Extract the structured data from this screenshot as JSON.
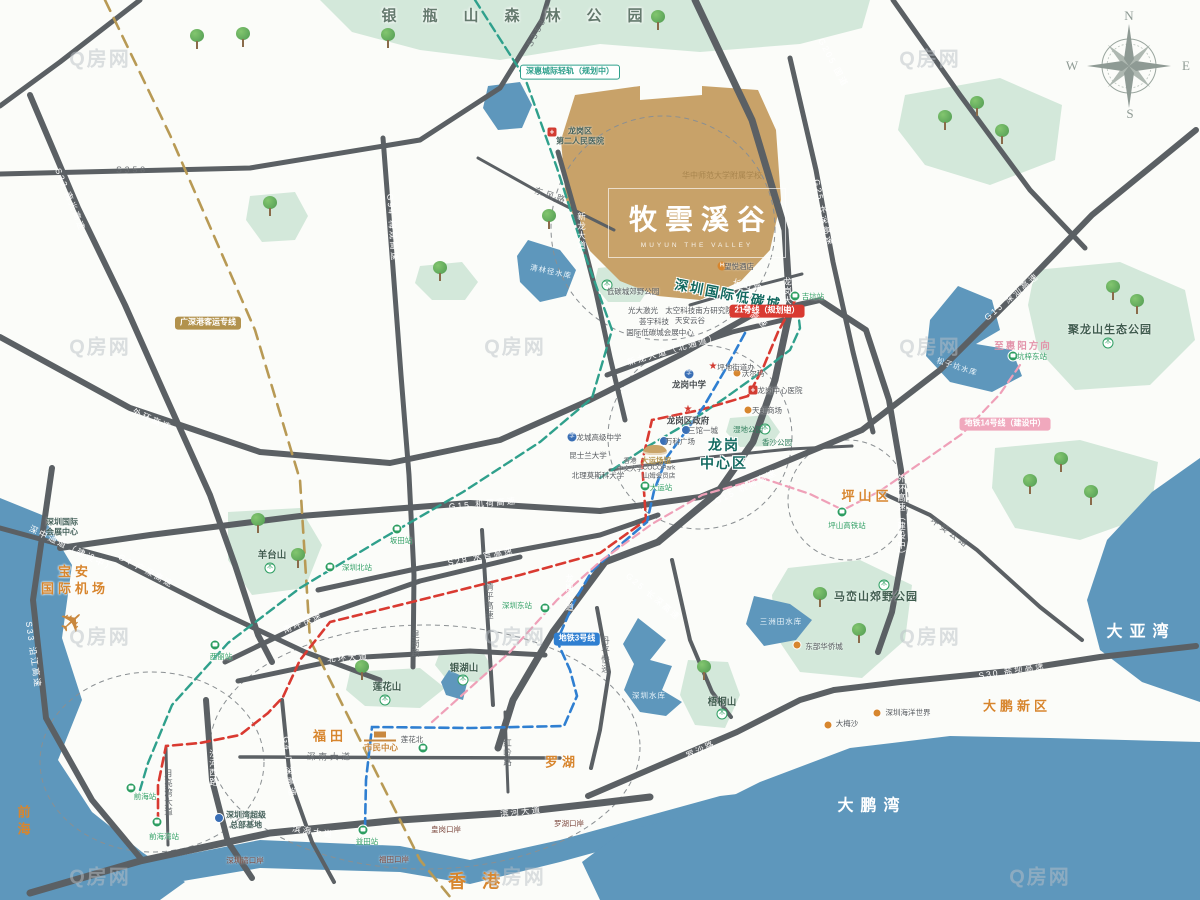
{
  "logo": {
    "title": "牧雲溪谷",
    "subtitle": "MUYUN THE VALLEY"
  },
  "compass": {
    "n": "N",
    "e": "E",
    "s": "S",
    "w": "W"
  },
  "watermark": {
    "text": "Q房网",
    "positions": [
      [
        100,
        57
      ],
      [
        515,
        345
      ],
      [
        930,
        57
      ],
      [
        100,
        345
      ],
      [
        100,
        635
      ],
      [
        515,
        635
      ],
      [
        930,
        345
      ],
      [
        930,
        635
      ],
      [
        100,
        875
      ],
      [
        515,
        875
      ],
      [
        1040,
        875
      ]
    ]
  },
  "map": {
    "labels": [
      {
        "t": "银瓶山森林公园",
        "x": 525,
        "y": 16,
        "c": "forest",
        "n": "label-yinpingshan-forest-park"
      },
      {
        "t": "深圳国际低碳城",
        "x": 728,
        "y": 295,
        "c": "lc",
        "r": 11,
        "n": "label-low-carbon-city"
      },
      {
        "t": "龙岗\n中心区",
        "x": 724,
        "y": 454,
        "c": "dt",
        "n": "label-longgang-center"
      },
      {
        "t": "坪山区",
        "x": 867,
        "y": 497,
        "c": "org",
        "n": "label-pingshan-district"
      },
      {
        "t": "大鹏新区",
        "x": 1017,
        "y": 707,
        "c": "org",
        "n": "label-dapeng-new-district"
      },
      {
        "t": "福田",
        "x": 330,
        "y": 737,
        "c": "org",
        "n": "label-futian"
      },
      {
        "t": "罗湖",
        "x": 562,
        "y": 763,
        "c": "org",
        "n": "label-luohu"
      },
      {
        "t": "香港",
        "x": 482,
        "y": 882,
        "c": "org-lg",
        "n": "label-hongkong"
      },
      {
        "t": "前海",
        "x": 22,
        "y": 822,
        "c": "org-v",
        "n": "label-qianhai"
      },
      {
        "t": "宝安\n国际机场",
        "x": 75,
        "y": 581,
        "c": "org",
        "n": "label-baoan-airport"
      },
      {
        "t": "大亚湾",
        "x": 1141,
        "y": 633,
        "c": "sea",
        "n": "label-daya-bay"
      },
      {
        "t": "大鹏湾",
        "x": 872,
        "y": 807,
        "c": "sea",
        "n": "label-dapeng-bay"
      },
      {
        "t": "聚龙山生态公园",
        "x": 1110,
        "y": 330,
        "c": "park"
      },
      {
        "t": "马峦山郊野公园",
        "x": 876,
        "y": 597,
        "c": "park"
      },
      {
        "t": "羊台山",
        "x": 272,
        "y": 556,
        "c": "park-s"
      },
      {
        "t": "莲花山",
        "x": 387,
        "y": 688,
        "c": "park-s"
      },
      {
        "t": "银湖山",
        "x": 464,
        "y": 669,
        "c": "park-s"
      },
      {
        "t": "梧桐山",
        "x": 722,
        "y": 703,
        "c": "park-s"
      },
      {
        "t": "松子坑水库",
        "x": 957,
        "y": 367,
        "c": "wat",
        "r": 18
      },
      {
        "t": "清林径水库",
        "x": 551,
        "y": 272,
        "c": "wat",
        "r": 12
      },
      {
        "t": "深圳水库",
        "x": 649,
        "y": 696,
        "c": "wat"
      },
      {
        "t": "三洲田水库",
        "x": 781,
        "y": 622,
        "c": "wat"
      },
      {
        "t": "深圳国际\n会展中心",
        "x": 62,
        "y": 528,
        "c": "poi2"
      },
      {
        "t": "深圳湾超级\n总部基地",
        "x": 246,
        "y": 821,
        "c": "poi2"
      },
      {
        "t": "市民中心",
        "x": 381,
        "y": 748,
        "c": "gold-s"
      },
      {
        "t": "莲花北",
        "x": 412,
        "y": 740,
        "c": "poi-t"
      },
      {
        "t": "福田口岸",
        "x": 394,
        "y": 860,
        "c": "port"
      },
      {
        "t": "皇岗口岸",
        "x": 446,
        "y": 830,
        "c": "port"
      },
      {
        "t": "罗湖口岸",
        "x": 569,
        "y": 824,
        "c": "port"
      },
      {
        "t": "深圳湾口岸",
        "x": 245,
        "y": 861,
        "c": "port"
      },
      {
        "t": "东部华侨城",
        "x": 824,
        "y": 647,
        "c": "poi-t"
      },
      {
        "t": "大梅沙",
        "x": 847,
        "y": 724,
        "c": "poi-t"
      },
      {
        "t": "深圳海洋世界",
        "x": 908,
        "y": 713,
        "c": "poi-t"
      },
      {
        "t": "坪山高铁站",
        "x": 847,
        "y": 526,
        "c": "sta"
      },
      {
        "t": "深圳北站",
        "x": 357,
        "y": 568,
        "c": "sta"
      },
      {
        "t": "深圳东站",
        "x": 517,
        "y": 606,
        "c": "sta"
      },
      {
        "t": "西丽站",
        "x": 221,
        "y": 657,
        "c": "sta"
      },
      {
        "t": "坂田站",
        "x": 401,
        "y": 541,
        "c": "sta"
      },
      {
        "t": "益田站",
        "x": 367,
        "y": 842,
        "c": "sta"
      },
      {
        "t": "前海站",
        "x": 145,
        "y": 797,
        "c": "sta"
      },
      {
        "t": "前海湾站",
        "x": 164,
        "y": 837,
        "c": "sta"
      },
      {
        "t": "坑梓东站",
        "x": 1032,
        "y": 357,
        "c": "sta"
      },
      {
        "t": "吉坑站",
        "x": 813,
        "y": 297,
        "c": "sta"
      },
      {
        "t": "大运站",
        "x": 661,
        "y": 488,
        "c": "sta"
      },
      {
        "t": "龙岗区\n第二人民医院",
        "x": 580,
        "y": 137,
        "c": "poi2"
      },
      {
        "t": "望悦酒店",
        "x": 739,
        "y": 267,
        "c": "poi-t"
      },
      {
        "t": "低碳城郊野公园",
        "x": 633,
        "y": 292,
        "c": "poi-t"
      },
      {
        "t": "太空科技南方研究院",
        "x": 699,
        "y": 311,
        "c": "poi-t"
      },
      {
        "t": "光大激光",
        "x": 643,
        "y": 311,
        "c": "poi-t"
      },
      {
        "t": "荟宇科技",
        "x": 654,
        "y": 322,
        "c": "poi-t"
      },
      {
        "t": "国际低碳城会展中心",
        "x": 660,
        "y": 333,
        "c": "poi-t"
      },
      {
        "t": "天安云谷",
        "x": 690,
        "y": 321,
        "c": "poi-t"
      },
      {
        "t": "坪地街道办",
        "x": 736,
        "y": 368,
        "c": "poi-t"
      },
      {
        "t": "龙岗中学",
        "x": 689,
        "y": 385,
        "c": "poi"
      },
      {
        "t": "龙岗区政府",
        "x": 688,
        "y": 421,
        "c": "poi"
      },
      {
        "t": "龙岗中心医院",
        "x": 780,
        "y": 391,
        "c": "poi-t"
      },
      {
        "t": "天虹商场",
        "x": 767,
        "y": 411,
        "c": "poi-t"
      },
      {
        "t": "沃尔玛",
        "x": 753,
        "y": 374,
        "c": "poi-t"
      },
      {
        "t": "湿地公园",
        "x": 748,
        "y": 430,
        "c": "park-t"
      },
      {
        "t": "香沙公园",
        "x": 777,
        "y": 443,
        "c": "park-t"
      },
      {
        "t": "三馆一城",
        "x": 703,
        "y": 431,
        "c": "poi-t"
      },
      {
        "t": "万科广场",
        "x": 680,
        "y": 442,
        "c": "poi-t"
      },
      {
        "t": "大运场馆",
        "x": 656,
        "y": 461,
        "c": "gold-t"
      },
      {
        "t": "香港\n中文大学",
        "x": 630,
        "y": 466,
        "c": "poi2-t"
      },
      {
        "t": "COCOPark\n山姆会员店",
        "x": 659,
        "y": 473,
        "c": "poi2-t"
      },
      {
        "t": "龙城高级中学",
        "x": 599,
        "y": 438,
        "c": "poi-t"
      },
      {
        "t": "昆士兰大学",
        "x": 588,
        "y": 456,
        "c": "poi-t"
      },
      {
        "t": "北理莫斯科大学",
        "x": 598,
        "y": 476,
        "c": "poi-t"
      },
      {
        "t": "华中师范大学附属学校",
        "x": 722,
        "y": 176,
        "c": "school-g"
      },
      {
        "t": "至惠阳方向",
        "x": 1023,
        "y": 347,
        "c": "pink-t"
      },
      {
        "t": "深惠城际轻轨（规划中）",
        "x": 570,
        "y": 72,
        "c": "pill pill-teal",
        "n": "label-intercity-rail"
      },
      {
        "t": "广深港客运专线",
        "x": 208,
        "y": 323,
        "c": "pill pill-tan",
        "n": "label-gsg-rail"
      },
      {
        "t": "地铁3号线",
        "x": 577,
        "y": 639,
        "c": "pill pill-blue",
        "n": "label-metro-line3"
      },
      {
        "t": "21号线（规划中）",
        "x": 767,
        "y": 311,
        "c": "pill pill-red",
        "n": "label-metro-line21"
      },
      {
        "t": "地铁14号线（建设中）",
        "x": 1005,
        "y": 424,
        "c": "pill pill-pink",
        "n": "label-metro-line14"
      },
      {
        "t": "S358",
        "x": 132,
        "y": 170,
        "c": "rd"
      },
      {
        "t": "S358",
        "x": 537,
        "y": 32,
        "c": "rd",
        "r": -62
      },
      {
        "t": "S33 南光高速",
        "x": 70,
        "y": 200,
        "c": "rw",
        "r": 68
      },
      {
        "t": "S33 沿江高速",
        "x": 33,
        "y": 655,
        "c": "rw",
        "r": 82
      },
      {
        "t": "G94 梅观高速",
        "x": 392,
        "y": 228,
        "c": "rw",
        "r": 86
      },
      {
        "t": "G205 国道",
        "x": 833,
        "y": 63,
        "c": "rw",
        "r": 62
      },
      {
        "t": "G25 长深高速",
        "x": 823,
        "y": 213,
        "c": "rw",
        "r": 78
      },
      {
        "t": "G25 长深高速",
        "x": 653,
        "y": 597,
        "c": "rw",
        "r": 40
      },
      {
        "t": "G15 深汕高速",
        "x": 1012,
        "y": 297,
        "c": "rw",
        "r": -40
      },
      {
        "t": "G15 机荷高速",
        "x": 483,
        "y": 504,
        "c": "rw",
        "r": -5
      },
      {
        "t": "G15 机荷高速",
        "x": 746,
        "y": 487,
        "c": "rw",
        "r": -26
      },
      {
        "t": "S28 水官高速",
        "x": 481,
        "y": 557,
        "c": "rw",
        "r": -11
      },
      {
        "t": "外环高速",
        "x": 152,
        "y": 420,
        "c": "rw",
        "r": 24
      },
      {
        "t": "外环高速",
        "x": 751,
        "y": 314,
        "c": "rw",
        "r": 40
      },
      {
        "t": "外环高速（建设中）",
        "x": 901,
        "y": 517,
        "c": "rwv"
      },
      {
        "t": "深中通道（建设中）",
        "x": 72,
        "y": 549,
        "c": "rw",
        "r": 26
      },
      {
        "t": "G4 广深高速",
        "x": 146,
        "y": 571,
        "c": "rw",
        "r": 28
      },
      {
        "t": "G4 广深高速",
        "x": 289,
        "y": 767,
        "c": "rw",
        "r": 84
      },
      {
        "t": "新龙大道",
        "x": 581,
        "y": 231,
        "c": "rwv"
      },
      {
        "t": "新龙大道（北通道）",
        "x": 673,
        "y": 350,
        "c": "rw",
        "r": -16
      },
      {
        "t": "东风路",
        "x": 551,
        "y": 196,
        "c": "rd",
        "r": 18
      },
      {
        "t": "长山路",
        "x": 748,
        "y": 286,
        "c": "rw",
        "r": 14
      },
      {
        "t": "龙岗大道",
        "x": 787,
        "y": 296,
        "c": "rwv"
      },
      {
        "t": "龙岗大道",
        "x": 569,
        "y": 593,
        "c": "rwv"
      },
      {
        "t": "南坪快速",
        "x": 303,
        "y": 623,
        "c": "rw",
        "r": -22
      },
      {
        "t": "北环大道",
        "x": 348,
        "y": 658,
        "c": "rw",
        "r": -4
      },
      {
        "t": "深南大道",
        "x": 330,
        "y": 757,
        "c": "rd"
      },
      {
        "t": "红岭路",
        "x": 507,
        "y": 753,
        "c": "rdv"
      },
      {
        "t": "清平高速",
        "x": 489,
        "y": 601,
        "c": "rdv"
      },
      {
        "t": "丹平快速",
        "x": 605,
        "y": 655,
        "c": "rdv"
      },
      {
        "t": "皇岗路",
        "x": 415,
        "y": 644,
        "c": "rdv"
      },
      {
        "t": "滨河大道",
        "x": 521,
        "y": 812,
        "c": "rw",
        "r": -6
      },
      {
        "t": "滨海大道",
        "x": 313,
        "y": 832,
        "c": "rw",
        "r": 9
      },
      {
        "t": "罗沙路",
        "x": 701,
        "y": 750,
        "c": "rw",
        "r": -25
      },
      {
        "t": "S30 盐坝高速",
        "x": 1012,
        "y": 671,
        "c": "rw",
        "r": -9
      },
      {
        "t": "坪葵公路",
        "x": 950,
        "y": 533,
        "c": "rd",
        "r": 36
      },
      {
        "t": "月亮湾大道",
        "x": 168,
        "y": 793,
        "c": "rdv"
      },
      {
        "t": "沙河西路",
        "x": 213,
        "y": 768,
        "c": "rwv"
      }
    ],
    "icons": [
      {
        "k": "station",
        "x": 842,
        "y": 512
      },
      {
        "k": "station",
        "x": 330,
        "y": 567
      },
      {
        "k": "station",
        "x": 545,
        "y": 608
      },
      {
        "k": "station",
        "x": 215,
        "y": 645
      },
      {
        "k": "station",
        "x": 397,
        "y": 529
      },
      {
        "k": "station",
        "x": 363,
        "y": 830
      },
      {
        "k": "station",
        "x": 131,
        "y": 788
      },
      {
        "k": "station",
        "x": 157,
        "y": 822
      },
      {
        "k": "station",
        "x": 1013,
        "y": 356
      },
      {
        "k": "station",
        "x": 795,
        "y": 296
      },
      {
        "k": "station",
        "x": 645,
        "y": 486
      },
      {
        "k": "station",
        "x": 423,
        "y": 748
      },
      {
        "k": "star",
        "x": 688,
        "y": 410
      },
      {
        "k": "star",
        "x": 713,
        "y": 367
      },
      {
        "k": "cross",
        "x": 552,
        "y": 132
      },
      {
        "k": "cross",
        "x": 753,
        "y": 390
      },
      {
        "k": "school",
        "x": 689,
        "y": 374
      },
      {
        "k": "school",
        "x": 572,
        "y": 437
      },
      {
        "k": "dot",
        "x": 797,
        "y": 645
      },
      {
        "k": "dot",
        "x": 828,
        "y": 725
      },
      {
        "k": "dot",
        "x": 877,
        "y": 713
      },
      {
        "k": "dot",
        "x": 737,
        "y": 373
      },
      {
        "k": "dot",
        "x": 748,
        "y": 410
      },
      {
        "k": "blue",
        "x": 219,
        "y": 818
      },
      {
        "k": "blue",
        "x": 686,
        "y": 430
      },
      {
        "k": "blue",
        "x": 664,
        "y": 441
      },
      {
        "k": "hotel",
        "x": 722,
        "y": 266
      },
      {
        "k": "park",
        "x": 607,
        "y": 285
      },
      {
        "k": "park",
        "x": 765,
        "y": 429
      },
      {
        "k": "park",
        "x": 1108,
        "y": 343
      },
      {
        "k": "park",
        "x": 884,
        "y": 585
      },
      {
        "k": "park",
        "x": 270,
        "y": 568
      },
      {
        "k": "park",
        "x": 385,
        "y": 700
      },
      {
        "k": "park",
        "x": 463,
        "y": 680
      },
      {
        "k": "park",
        "x": 722,
        "y": 714
      },
      {
        "k": "building",
        "x": 380,
        "y": 736
      },
      {
        "k": "stadium",
        "x": 655,
        "y": 450
      },
      {
        "k": "plane",
        "x": 73,
        "y": 623
      }
    ],
    "trees": [
      [
        197,
        47
      ],
      [
        243,
        45
      ],
      [
        388,
        46
      ],
      [
        658,
        28
      ],
      [
        945,
        128
      ],
      [
        977,
        114
      ],
      [
        1002,
        142
      ],
      [
        270,
        214
      ],
      [
        440,
        279
      ],
      [
        549,
        227
      ],
      [
        1113,
        298
      ],
      [
        1137,
        312
      ],
      [
        1030,
        492
      ],
      [
        1061,
        470
      ],
      [
        1091,
        503
      ],
      [
        258,
        531
      ],
      [
        298,
        566
      ],
      [
        362,
        678
      ],
      [
        820,
        605
      ],
      [
        859,
        641
      ],
      [
        704,
        678
      ]
    ]
  }
}
